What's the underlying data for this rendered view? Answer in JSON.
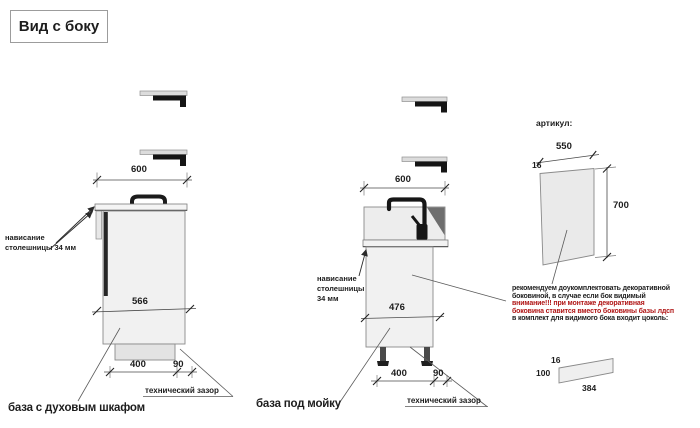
{
  "title": "Вид с боку",
  "colors": {
    "warning_text": "#b01616",
    "line_gray": "#8a8a8a"
  },
  "left_unit": {
    "caption": "база с духовым шкафом",
    "overhang_label": {
      "line1": "нависание",
      "line2": "столешницы 34 мм"
    },
    "gap_label": "технический зазор",
    "dims": {
      "top_width": "600",
      "inner_width": "566",
      "bottom_depth": "400",
      "bottom_gap": "90"
    }
  },
  "sink_unit": {
    "caption": "база под мойку",
    "overhang_label": {
      "line1": "нависание",
      "line2": "столешницы",
      "line3": "34 мм"
    },
    "gap_label": "технический зазор",
    "dims": {
      "top_width": "600",
      "inner_width": "476",
      "bottom_depth": "400",
      "bottom_gap": "90"
    }
  },
  "side_panel": {
    "header": "артикул:",
    "dims": {
      "width": "550",
      "thickness": "16",
      "height": "700"
    },
    "note": {
      "line1": "рекомендуем доукомплектовать декоративной",
      "line2": "боковиной, в случае если бок видимый",
      "line3": "внимание!!! при монтаже декоративная",
      "line4": "боковина ставится вместо боковины базы лдсп",
      "line5": "в комплект для видимого бока входит цоколь:"
    }
  },
  "plinth": {
    "dims": {
      "thickness": "16",
      "height": "100",
      "length": "384"
    }
  }
}
